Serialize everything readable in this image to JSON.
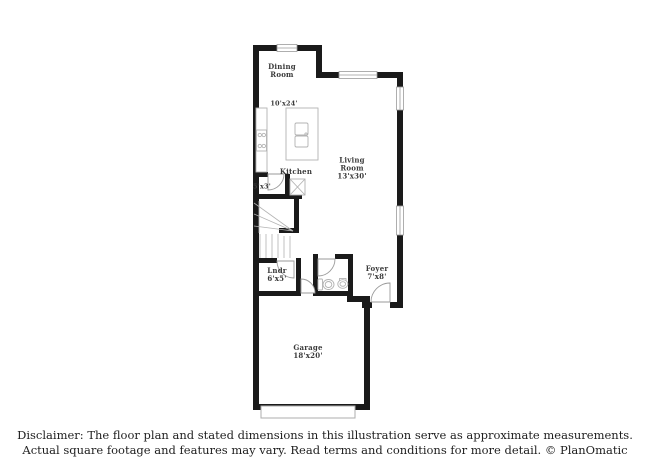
{
  "plan_labels": {
    "dining": "Dining\nRoom",
    "dining_dims": "10'x24'",
    "kitchen": "Kitchen",
    "living": "Living\nRoom\n13'x30'",
    "closet_dims": "5'x3'",
    "laundry": "Lndr\n6'x5'",
    "foyer": "Foyer\n7'x8'",
    "garage": "Garage\n18'x20'"
  },
  "disclaimer": {
    "line1": "Disclaimer: The floor plan and stated dimensions in this illustration serve as approximate measurements.",
    "line2": "Actual square footage and features may vary. Read terms and conditions for more detail. © PlanOmatic"
  },
  "colors": {
    "wall": "#1a1a1a",
    "fixture_line": "#b0b0b0",
    "window_line": "#9a9a9a",
    "label_text": "#3a3a3a",
    "background": "#ffffff"
  }
}
